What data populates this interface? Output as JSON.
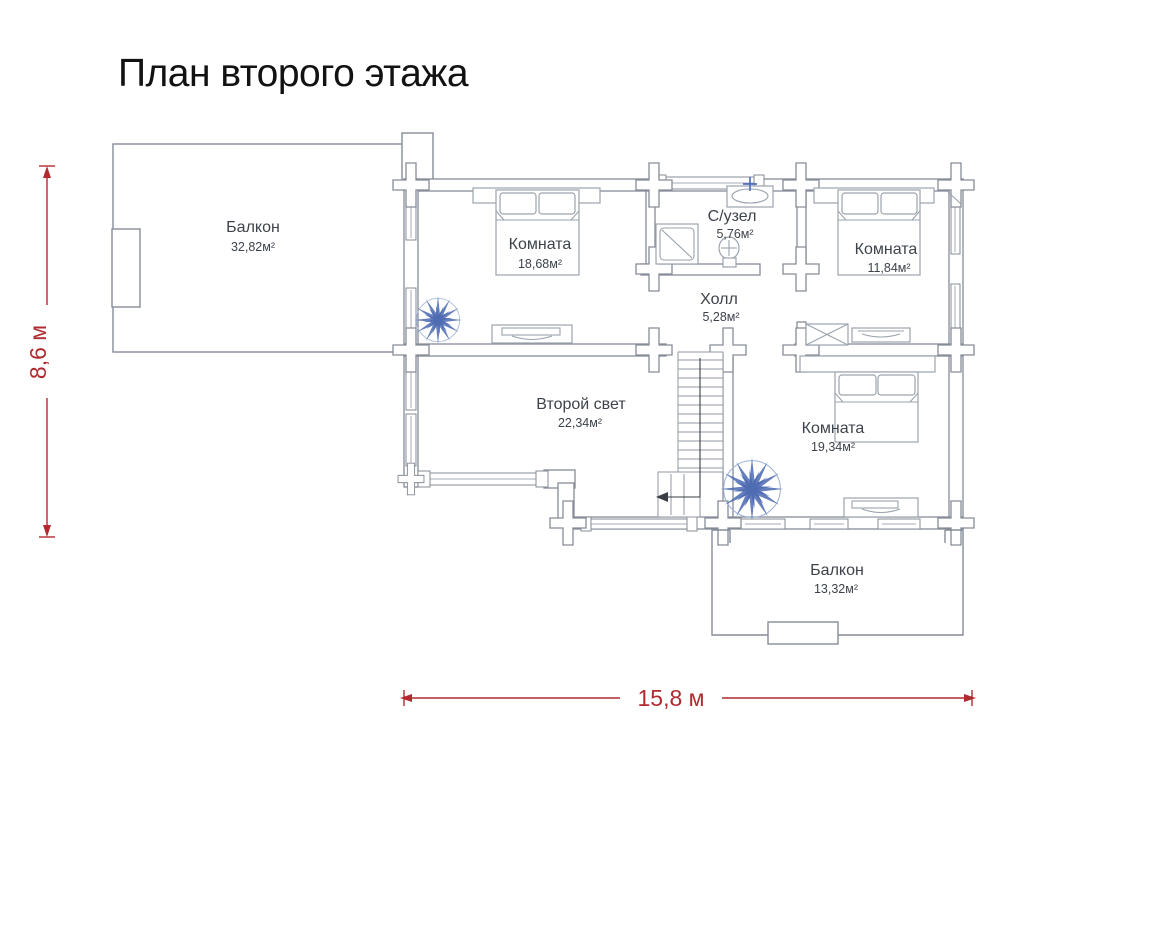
{
  "title": "План второго этажа",
  "dimensions": {
    "height_label": "8,6 м",
    "width_label": "15,8 м"
  },
  "rooms": {
    "balcony_top": {
      "name": "Балкон",
      "area": "32,82м²"
    },
    "bedroom1": {
      "name": "Комната",
      "area": "18,68м²"
    },
    "bathroom": {
      "name": "С/узел",
      "area": "5,76м²"
    },
    "bedroom2": {
      "name": "Комната",
      "area": "11,84м²"
    },
    "hall": {
      "name": "Холл",
      "area": "5,28м²"
    },
    "second_light": {
      "name": "Второй свет",
      "area": "22,34м²"
    },
    "bedroom3": {
      "name": "Комната",
      "area": "19,34м²"
    },
    "balcony_bottom": {
      "name": "Балкон",
      "area": "13,32м²"
    }
  },
  "colors": {
    "accent": "#b02a30",
    "wall": "#868c97",
    "furniture": "#9aa3ad",
    "plant": "#4a68b0",
    "label": "#3d434b"
  }
}
